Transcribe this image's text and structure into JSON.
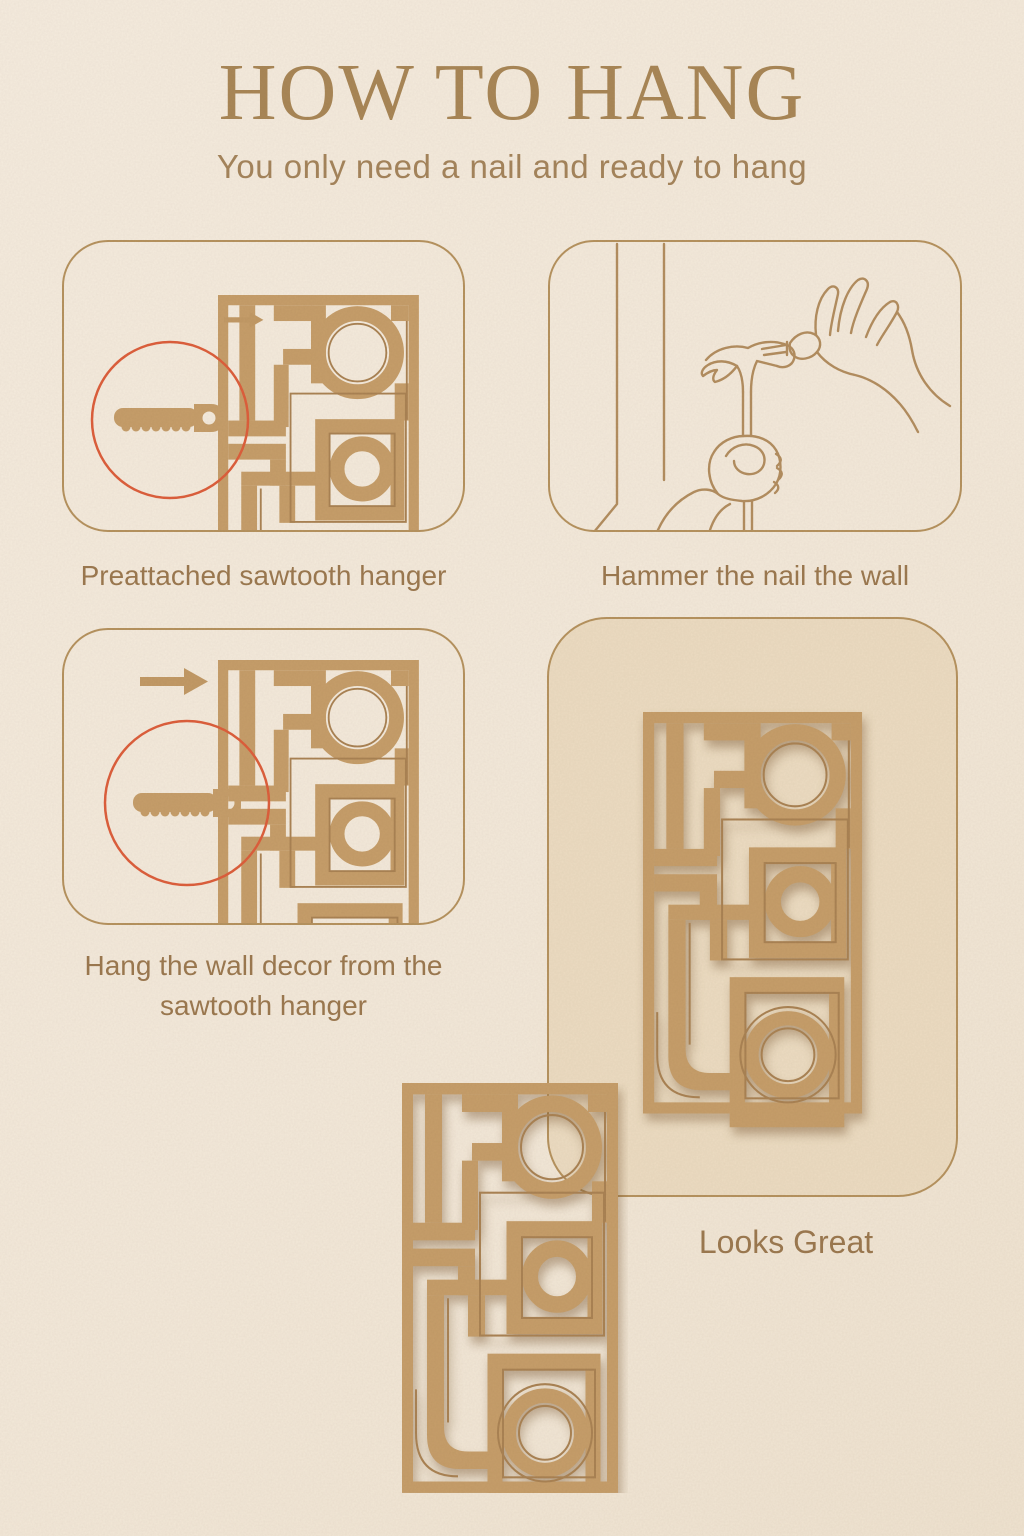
{
  "page": {
    "title": "HOW TO HANG",
    "subtitle": "You only need a nail and ready to hang"
  },
  "steps": [
    {
      "caption": "Preattached sawtooth hanger",
      "icons": [
        "wall-decor-partial",
        "magnifier-circle",
        "sawtooth-hanger",
        "arrow-right"
      ]
    },
    {
      "caption": "Hammer the nail the wall",
      "icons": [
        "wall-corner",
        "hammer",
        "hand-holding-nail"
      ]
    },
    {
      "caption_line1": "Hang the wall decor from the",
      "caption_line2": "sawtooth hanger",
      "icons": [
        "arrow-right",
        "wall-decor-partial",
        "magnifier-circle",
        "sawtooth-hanger"
      ]
    },
    {
      "caption": "Looks Great",
      "icons": [
        "wall-decor-full"
      ]
    }
  ],
  "icons": {
    "sawtooth-hanger": "toothed-bar-with-nail-hole",
    "magnifier-circle": "red-circle-outline",
    "arrow-right": "solid-right-arrow",
    "hammer": "line-art-claw-hammer",
    "hand-holding-nail": "line-art-pinching-hand",
    "wall-corner": "line-art-wall-edge",
    "wall-decor-full": "mid-century-geometric-panel",
    "wall-decor-partial": "mid-century-geometric-panel-cropped"
  },
  "colors": {
    "background": "#f3e9da",
    "decor_tan": "#c69e6a",
    "engrave_line": "#aa8354",
    "line_art": "#b38e60",
    "panel_border": "#b6935f",
    "panel_fill": "#ecdcc2",
    "magnifier_red": "#dd5f3c",
    "title_text": "#a98757",
    "caption_text": "#9c7950"
  }
}
